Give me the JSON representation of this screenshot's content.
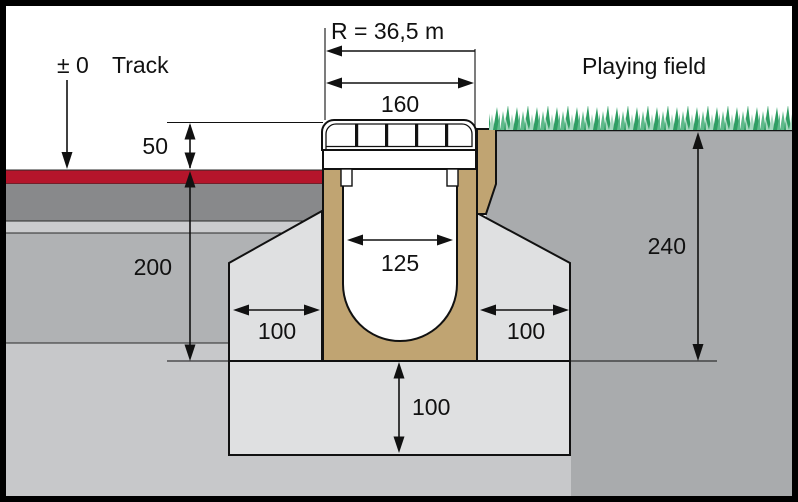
{
  "title": "Drainage channel installation cross-section between track and playing field",
  "labels": {
    "radius": "R = 36,5 m",
    "track_elevation": "± 0",
    "track": "Track",
    "playing_field": "Playing field",
    "top_width": "160",
    "grate_height": "50",
    "track_depth": "200",
    "channel_inner_width": "125",
    "side_clearance_left": "100",
    "side_clearance_right": "100",
    "bedding_depth": "100",
    "field_depth": "240"
  },
  "colors": {
    "track_red": "#b5152b",
    "layer_dark_gray": "#88898b",
    "layer_light_gray": "#cbccce",
    "layer_mid_gray": "#b0b2b4",
    "subsoil_gray": "#c7c8ca",
    "field_soil_gray": "#a9abad",
    "concrete_gray": "#dfe0e1",
    "channel_tan": "#c0a472",
    "grass_dark": "#2f9e63",
    "grass_mid": "#5fba8b",
    "grass_light": "#a6d8bf",
    "white": "#ffffff",
    "line_black": "#1a1a1a"
  }
}
